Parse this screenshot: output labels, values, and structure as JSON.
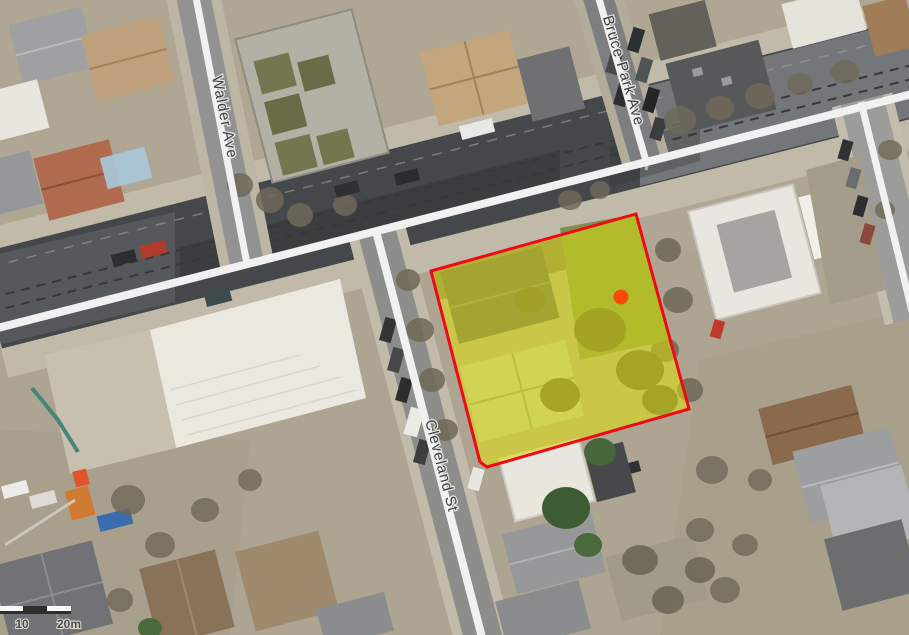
{
  "map": {
    "street_labels": [
      {
        "id": "walder-ave",
        "text": "Walder Ave"
      },
      {
        "id": "bruce-park-ave",
        "text": "Bruce Park Ave"
      },
      {
        "id": "cleveland-st",
        "text": "Cleveland St"
      }
    ],
    "scale_bar": {
      "mid_label": "10",
      "end_label": "20m"
    },
    "overlay": {
      "parcel_fill": "#e8e800",
      "parcel_stroke": "#ee0a16",
      "marker_color": "#fb4a0c",
      "road_line_color": "#f1f1f1"
    }
  }
}
